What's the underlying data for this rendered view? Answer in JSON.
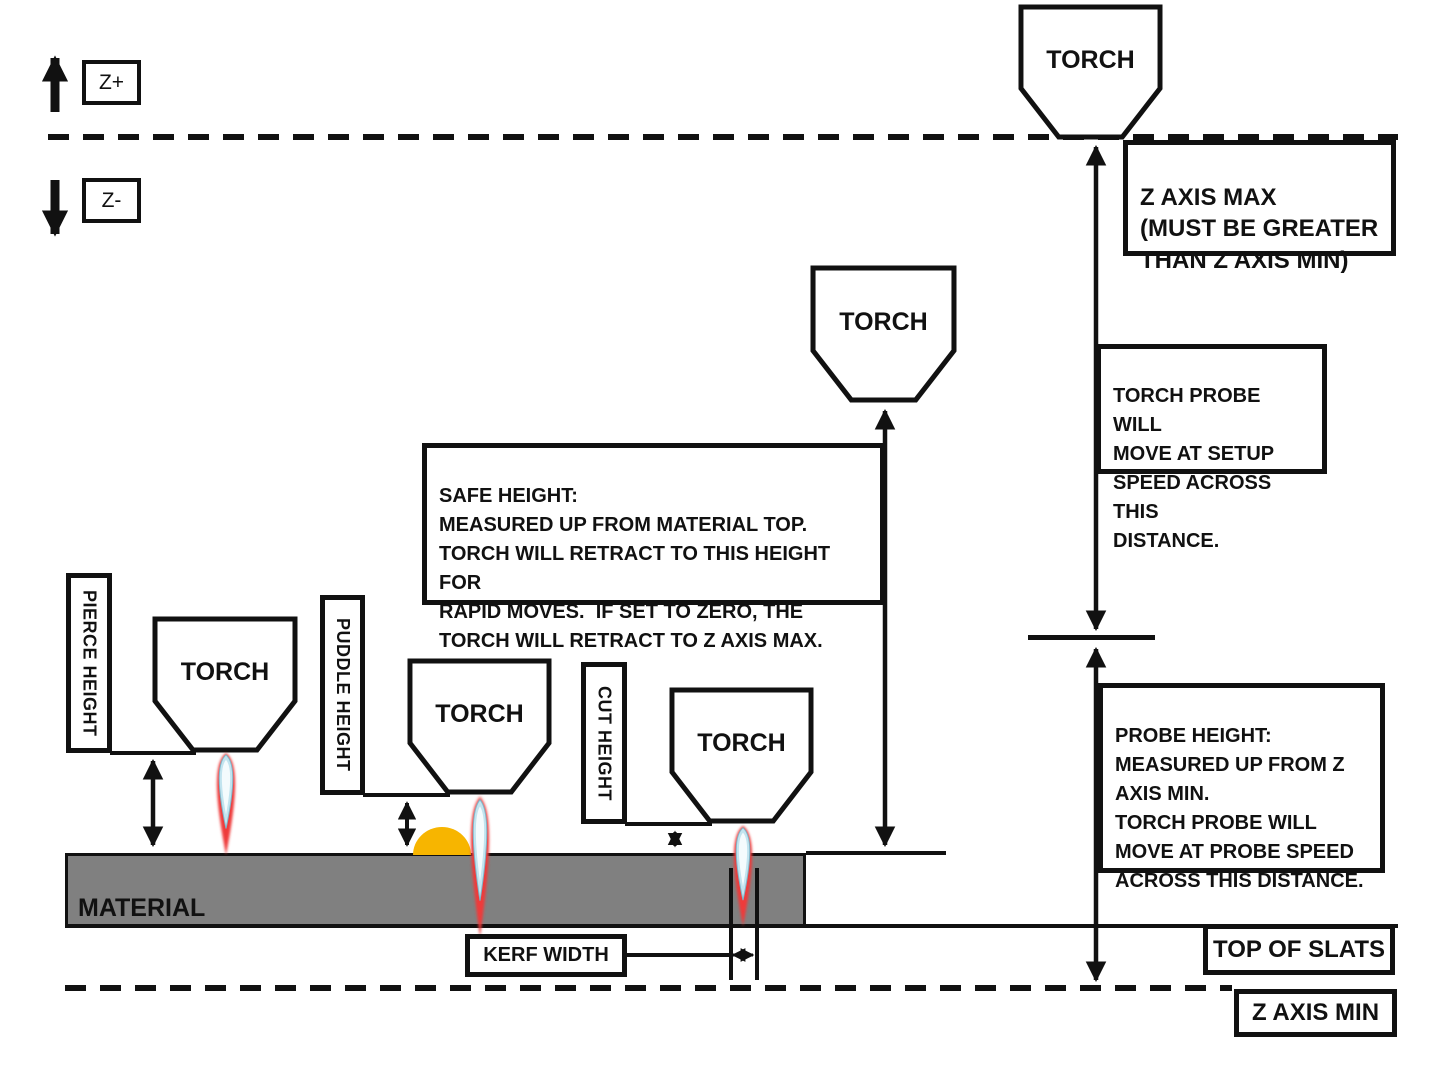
{
  "labels": {
    "torch": "TORCH",
    "z_plus": "Z+",
    "z_minus": "Z-",
    "material": "MATERIAL",
    "pierce_height": "PIERCE HEIGHT",
    "puddle_height": "PUDDLE HEIGHT",
    "cut_height": "CUT HEIGHT",
    "kerf_width": "KERF WIDTH",
    "top_of_slats": "TOP OF SLATS",
    "z_axis_min": "Z AXIS MIN"
  },
  "callouts": {
    "z_axis_max": "Z AXIS MAX\n(MUST BE GREATER\nTHAN Z AXIS MIN)",
    "torch_probe": "TORCH PROBE WILL\nMOVE AT SETUP\nSPEED ACROSS THIS\nDISTANCE.",
    "safe_height": "SAFE HEIGHT:\nMEASURED UP FROM MATERIAL TOP.\nTORCH WILL RETRACT TO THIS HEIGHT FOR\nRAPID MOVES.  IF SET TO ZERO, THE\nTORCH WILL RETRACT TO Z AXIS MAX.",
    "probe_height": "PROBE HEIGHT:\nMEASURED UP FROM Z\nAXIS MIN.\nTORCH PROBE WILL\nMOVE AT PROBE SPEED\nACROSS THIS DISTANCE."
  },
  "colors": {
    "line": "#111111",
    "material_fill": "#808080",
    "puddle_fill": "#F7B500",
    "flame_outer": "#EE3A3A",
    "flame_inner": "#C2E4EF",
    "flame_core": "#F4FBFD",
    "background": "#FFFFFF"
  }
}
